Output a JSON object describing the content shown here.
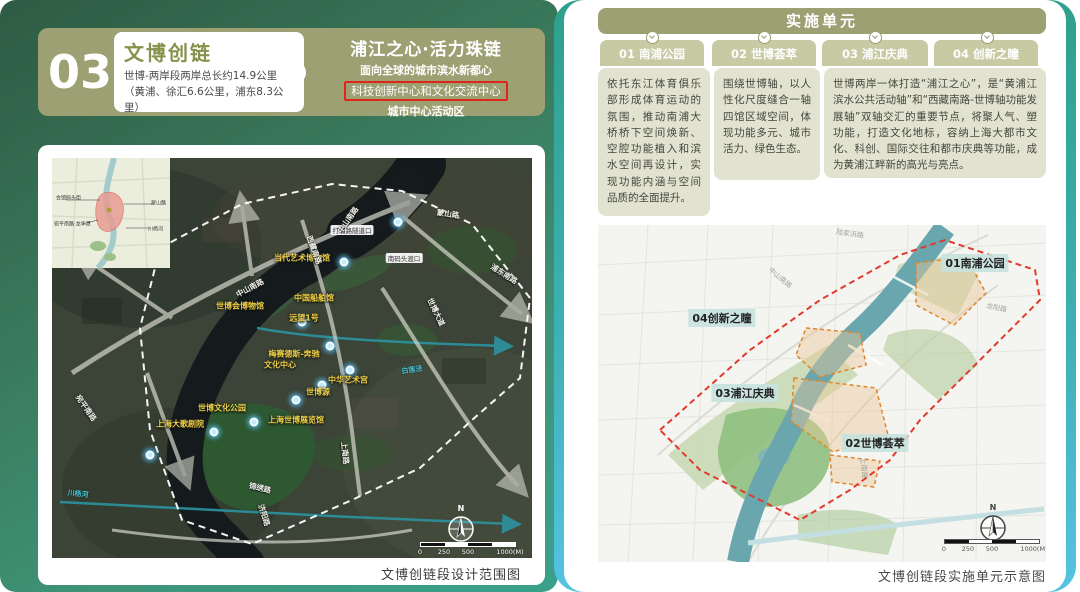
{
  "left_panel": {
    "index_number": "03",
    "title_card": {
      "title": "文博创链",
      "description": "世博-两岸段两岸总长约14.9公里（黄浦、徐汇6.6公里，浦东8.3公里）"
    },
    "slogan": {
      "title": "浦江之心·活力珠链",
      "line1": "面向全球的城市滨水新都心",
      "line2": "科技创新中心和文化交流中心",
      "line3": "城市中心活动区"
    },
    "map": {
      "caption": "文博创链段设计范围图",
      "north_label": "N",
      "scale_labels": [
        "0",
        "250",
        "500",
        "1000(M)"
      ],
      "inset_labels": [
        "会馆码头街",
        "蒙山路",
        "宛平南路·龙华港",
        "川杨河"
      ],
      "poi_labels": [
        "当代艺术博物馆",
        "世博会博物馆",
        "中国船舶馆",
        "远望1号",
        "梅赛德斯-奔驰",
        "文化中心",
        "中华艺术宫",
        "世博源",
        "上海世博展览馆",
        "世博文化公园",
        "上海大歌剧院"
      ],
      "station_labels": [
        "打浦路隧道口",
        "南码头渡口"
      ],
      "road_labels": [
        "中山南路",
        "中山南路",
        "蒙山路",
        "浦东南路",
        "西藏南路",
        "世博大道",
        "上南路",
        "锦绣路",
        "济阳路",
        "宛平南路"
      ],
      "water_labels": [
        "白莲泾",
        "川杨河"
      ]
    }
  },
  "right_panel": {
    "header": "实施单元",
    "tabs": [
      {
        "label": "01 南浦公园"
      },
      {
        "label": "02 世博荟萃"
      },
      {
        "label": "03 浦江庆典"
      },
      {
        "label": "04 创新之瞳"
      }
    ],
    "descriptions": [
      "依托东江体育俱乐部形成体育运动的氛围，推动南浦大桥桥下空间焕新、空腔功能植入和滨水空间再设计，实现功能内涵与空间品质的全面提升。",
      "围绕世博轴，以人性化尺度缝合一轴四馆区域空间，体现功能多元、城市活力、绿色生态。",
      "世博两岸一体打造“浦江之心”，是“黄浦江滨水公共活动轴”和“西藏南路-世博轴功能发展轴”双轴交汇的重要节点，将聚人气、塑功能，打造文化地标，容纳上海大都市文化、科创、国际交往和都市庆典等功能，成为黄浦江畔新的高光与亮点。"
    ],
    "map": {
      "caption": "文博创链段实施单元示意图",
      "north_label": "N",
      "scale_labels": [
        "0",
        "250",
        "500",
        "1000(M)"
      ],
      "area_labels": [
        "01南浦公园",
        "04创新之瞳",
        "03浦江庆典",
        "02世博荟萃"
      ],
      "road_labels": [
        "陆家浜路",
        "中山南路",
        "龙阳路",
        "上南路"
      ]
    }
  },
  "colors": {
    "panel_green_dark": "#2e5b43",
    "panel_green_light": "#3aa18c",
    "olive_header": "#9ca072",
    "tab_olive": "#c7caa3",
    "desc_block_bg": "#e1e3d0",
    "accent_red": "#e1251b",
    "title_green": "#87914c",
    "teal_border_top": "#2fa08c",
    "teal_border_bottom": "#55c3e2",
    "poi_yellow": "#f0cf45",
    "boundary_red_dash": "#e23a2c"
  }
}
